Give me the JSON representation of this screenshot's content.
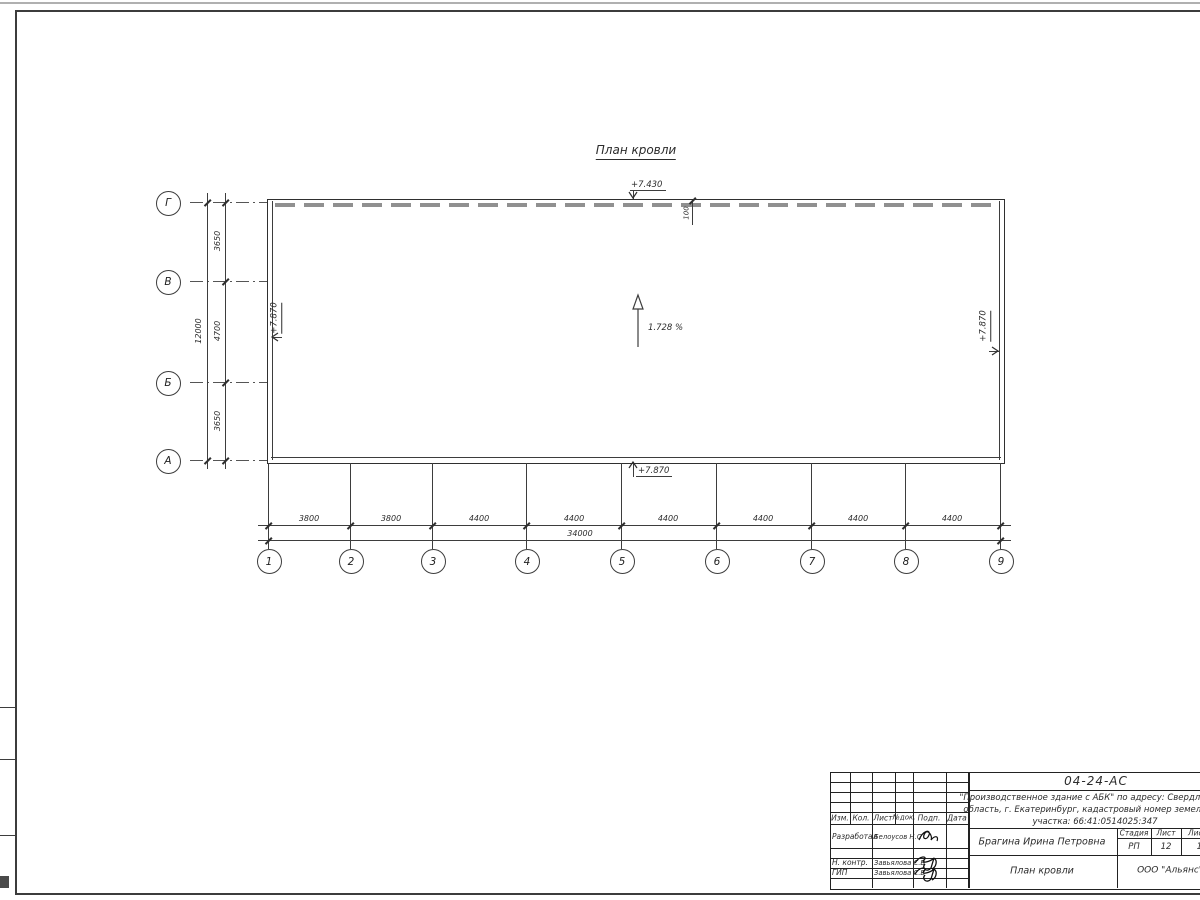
{
  "drawing": {
    "title": "План кровли",
    "slope_label": "1.728 %",
    "elevation_top": "+7.430",
    "elevation_left": "+7.870",
    "elevation_right": "+7.870",
    "elevation_bottom": "+7.870",
    "parapet_offset": "100",
    "axes_horizontal": [
      "1",
      "2",
      "3",
      "4",
      "5",
      "6",
      "7",
      "8",
      "9"
    ],
    "axes_vertical": [
      "Г",
      "В",
      "Б",
      "А"
    ],
    "dims_bottom": [
      "3800",
      "3800",
      "4400",
      "4400",
      "4400",
      "4400",
      "4400",
      "4400"
    ],
    "dim_bottom_total": "34000",
    "dims_left": [
      "3650",
      "4700",
      "3650"
    ],
    "dim_left_total": "12000"
  },
  "titleblock": {
    "doc_number": "04-24-АС",
    "project_line1": "\"Производственное здание с АБК\" по адресу: Свердловская",
    "project_line2": "область, г. Екатеринбург, кадастровый номер земельного",
    "project_line3": "участка: 66:41:0514025:347",
    "rev_headers": [
      "Изм.",
      "Кол.",
      "Лист",
      "№док.",
      "Подп.",
      "Дата"
    ],
    "roles": [
      {
        "role": "Разработал",
        "name": "Белоусов Н.С"
      },
      {
        "role": "Н. контр.",
        "name": "Завьялова С.В"
      },
      {
        "role": "ГИП",
        "name": "Завьялова С.В"
      }
    ],
    "client": "Брагина Ирина Петровна",
    "sheet_title": "План кровли",
    "org": "ООО \"Альянс\"",
    "stage_headers": [
      "Стадия",
      "Лист",
      "Листов"
    ],
    "stage_values": [
      "РП",
      "12",
      "13"
    ]
  }
}
